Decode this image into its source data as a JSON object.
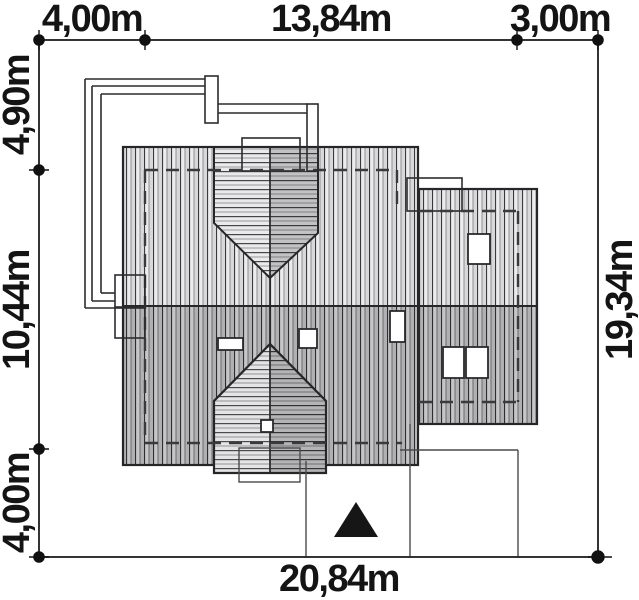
{
  "dimensions": {
    "top": [
      "4,00m",
      "13,84m",
      "3,00m"
    ],
    "left": [
      "4,90m",
      "10,44m",
      "4,00m"
    ],
    "right": [
      "19,34m"
    ],
    "bottom": [
      "20,84m"
    ]
  },
  "colors": {
    "background": "#ffffff",
    "line": "#1d1d1f",
    "roof_hatch_light": "#ececee",
    "roof_hatch_dark": "#c6c6c8",
    "gable_left_light": "#eaeaec",
    "gable_right_dark": "#b4b4b6",
    "entrance_marker": "#161616"
  },
  "icons": {
    "entrance_marker": "filled-triangle-up"
  }
}
